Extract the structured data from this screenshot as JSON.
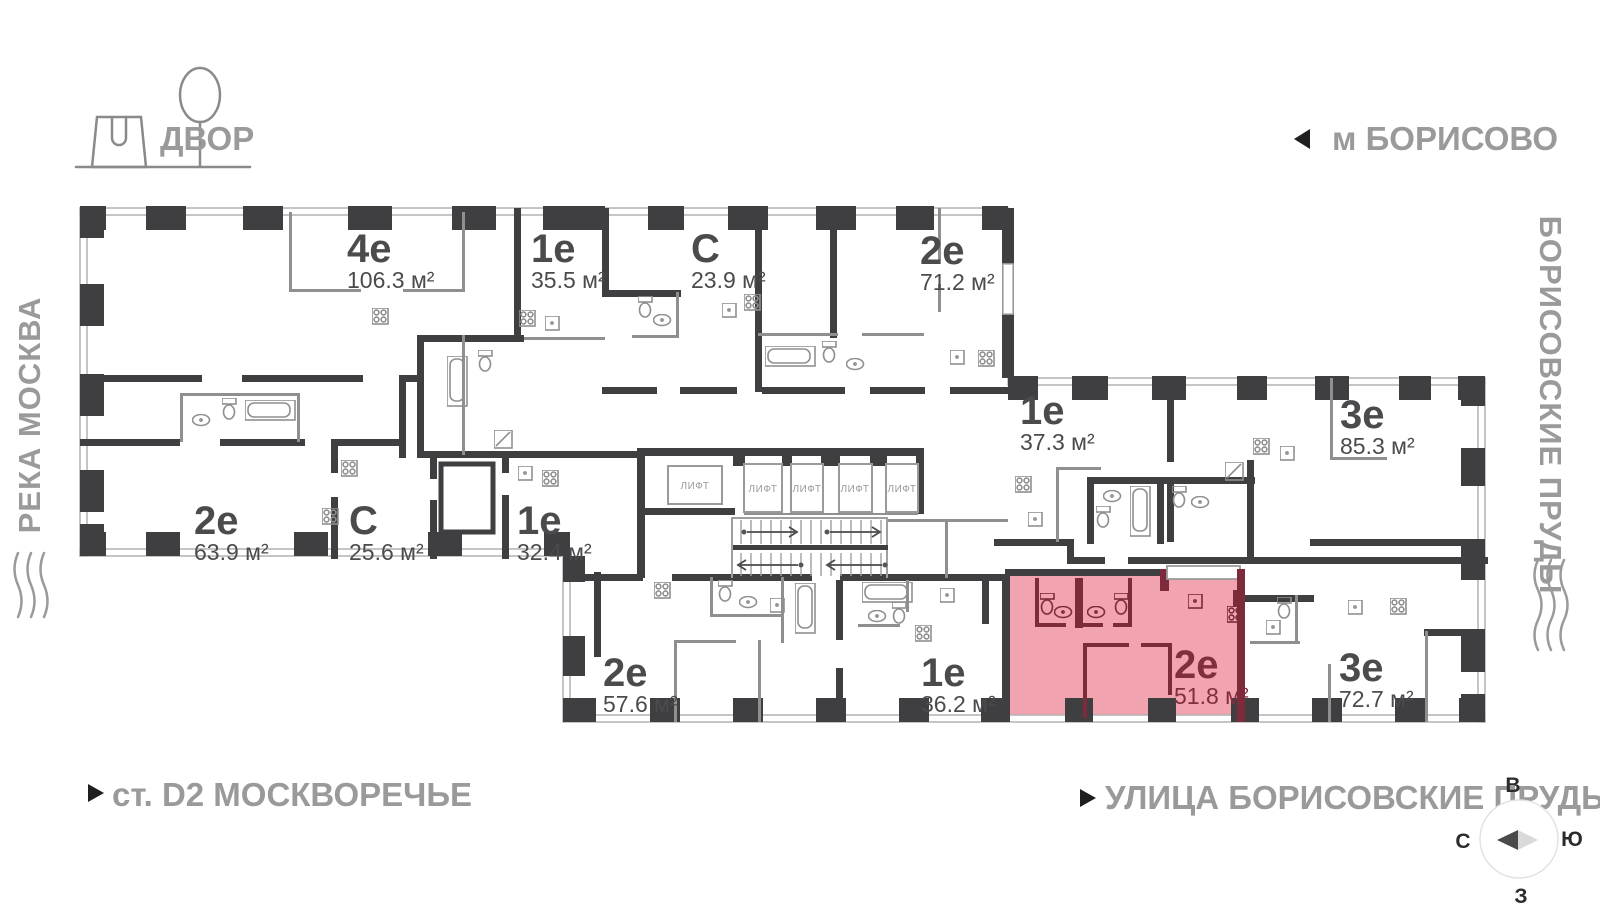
{
  "surroundings": {
    "courtyard_label": "ДВОР",
    "metro_label": "м БОРИСОВО",
    "river_label": "РЕКА МОСКВА",
    "right_street_label": "БОРИСОВСКИЕ ПРУДЫ",
    "station_label": "ст. D2 МОСКВОРЕЧЬЕ",
    "street_label": "УЛИЦА БОРИСОВСКИЕ ПРУДЫ"
  },
  "compass": {
    "east": "В",
    "south": "Ю",
    "west": "З",
    "north": "С"
  },
  "elevator": {
    "label": "ЛИФТ",
    "count": 5
  },
  "apartments": [
    {
      "type": "4е",
      "area": "106.3 м²",
      "selected": false
    },
    {
      "type": "1е",
      "area": "35.5 м²",
      "selected": false
    },
    {
      "type": "С",
      "area": "23.9 м²",
      "selected": false
    },
    {
      "type": "2е",
      "area": "71.2 м²",
      "selected": false
    },
    {
      "type": "2е",
      "area": "63.9 м²",
      "selected": false
    },
    {
      "type": "С",
      "area": "25.6 м²",
      "selected": false
    },
    {
      "type": "1е",
      "area": "32.4 м²",
      "selected": false
    },
    {
      "type": "2е",
      "area": "57.6 м²",
      "selected": false
    },
    {
      "type": "1е",
      "area": "36.2 м²",
      "selected": false
    },
    {
      "type": "1е",
      "area": "37.3 м²",
      "selected": false
    },
    {
      "type": "3е",
      "area": "85.3 м²",
      "selected": false
    },
    {
      "type": "2е",
      "area": "51.8 м²",
      "selected": true
    },
    {
      "type": "3е",
      "area": "72.7 м²",
      "selected": false
    }
  ],
  "colors": {
    "wall": "#3f3f41",
    "partition": "#8f8f8f",
    "selected_fill": "#f1a3af",
    "selected_wall": "#7d2b3a",
    "selected_text": "#802d3e",
    "label_text": "#4b4b4d",
    "map_text": "#9a9a9a"
  }
}
